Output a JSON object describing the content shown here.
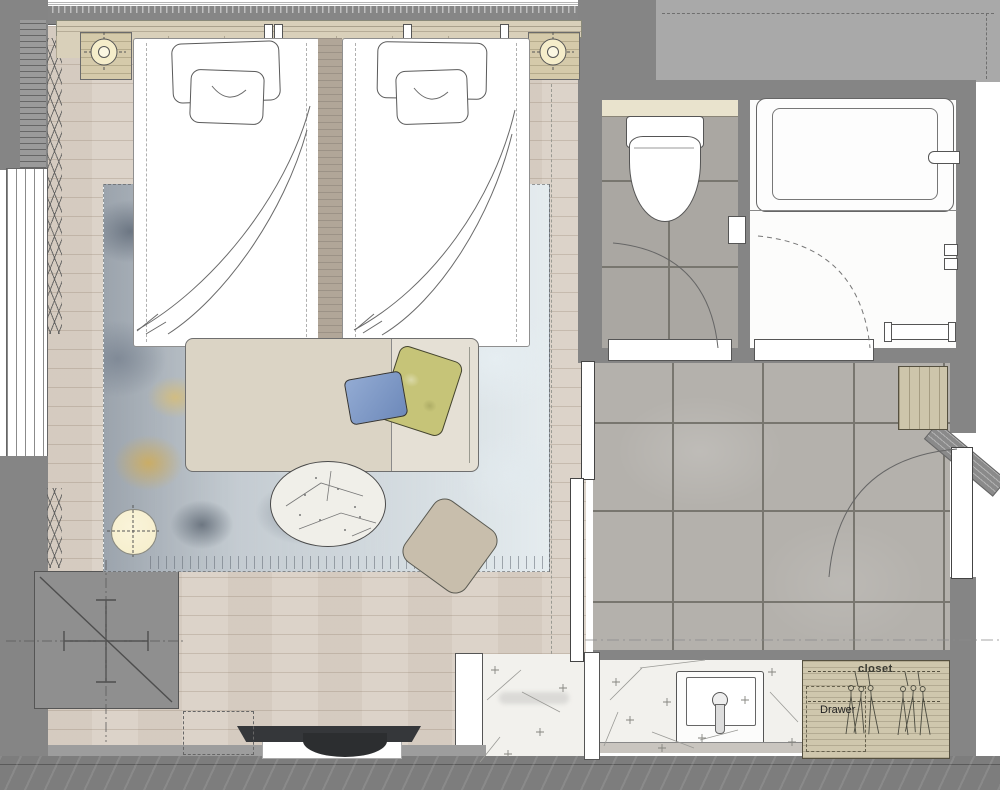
{
  "plan": {
    "type": "floor-plan",
    "labels": {
      "closet": "closet",
      "drawer": "Drawer"
    },
    "rooms": [
      "bedroom",
      "toilet-room",
      "bathroom",
      "entry-hall",
      "vanity-area",
      "closet"
    ],
    "fixtures": [
      "twin-bed-left",
      "twin-bed-right",
      "headboard-rail",
      "nightstand-left",
      "nightstand-right",
      "table-lamp-left",
      "table-lamp-right",
      "wall-reading-lights",
      "area-rug",
      "daybed-bench",
      "accent-pillow-blue",
      "accent-pillow-green",
      "round-coffee-table",
      "ottoman",
      "floor-lamp",
      "tv",
      "tv-shelf",
      "window",
      "curtain",
      "structural-column",
      "toilet",
      "toilet-paper-holder",
      "bathtub",
      "tub-spout",
      "shower-mixer",
      "shower-bench",
      "door-swing-toilet",
      "door-swing-bathroom",
      "entry-door",
      "sink-vanity",
      "faucet",
      "wardrobe-hangers",
      "drawer-unit",
      "luggage-cabinet",
      "sliding-partition"
    ],
    "colors": {
      "wall": "#858585",
      "wall2": "#9d9d9d",
      "outside": "#a9a9a9",
      "wood": "#dcd3c9",
      "tile": "#b4b1ac",
      "toilet_tile": "#aaa7a2",
      "grout": "#78766f",
      "cream": "#e9e3cd",
      "line": "#555555",
      "headboard": "#d9d0ba",
      "nightstand": "#d5caaa",
      "lamp": "#f5edca",
      "rug_base": "#c7ced3",
      "bench": "#dbd4c5",
      "pillow_blue": "#7e99c5",
      "pillow_green": "#c6c478",
      "ottoman": "#c8beac",
      "marble": "#f0efe9",
      "terrazzo": "#f2f1ed",
      "closet": "#cfc7ad",
      "tv": "#35373a"
    }
  }
}
